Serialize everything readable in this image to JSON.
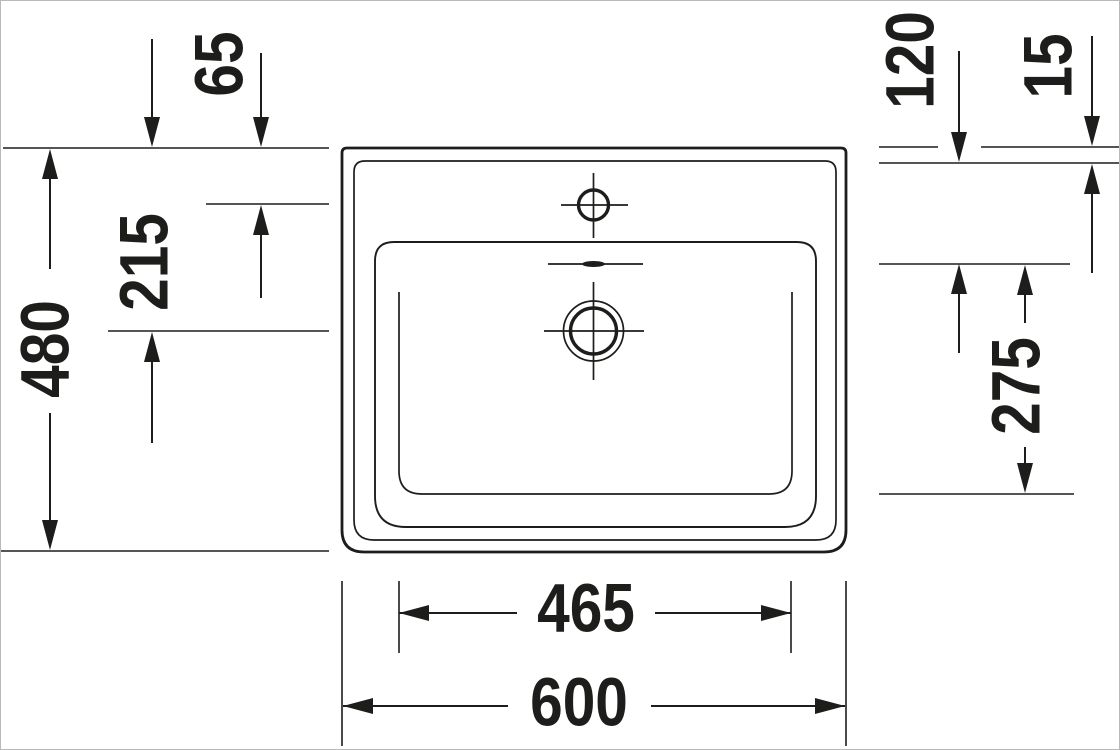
{
  "drawing": {
    "title": "Washbasin technical dimension drawing, plan view",
    "type": "engineering-diagram",
    "style": {
      "line_color": "#1d1d1b",
      "background_color": "#ffffff"
    },
    "dimensions": {
      "overall_depth": "480",
      "drain_center_from_back_edge": "215",
      "tap_hole_from_back_edge": "65",
      "overflow_drop_from_rim": "120",
      "rim_thickness": "15",
      "bowl_inner_depth_front": "275",
      "bowl_inner_width": "465",
      "overall_width": "600"
    },
    "features": {
      "tap_hole": "tap hole with centerlines",
      "overflow": "overflow slot",
      "drain": "drain outlet with centerlines"
    }
  }
}
